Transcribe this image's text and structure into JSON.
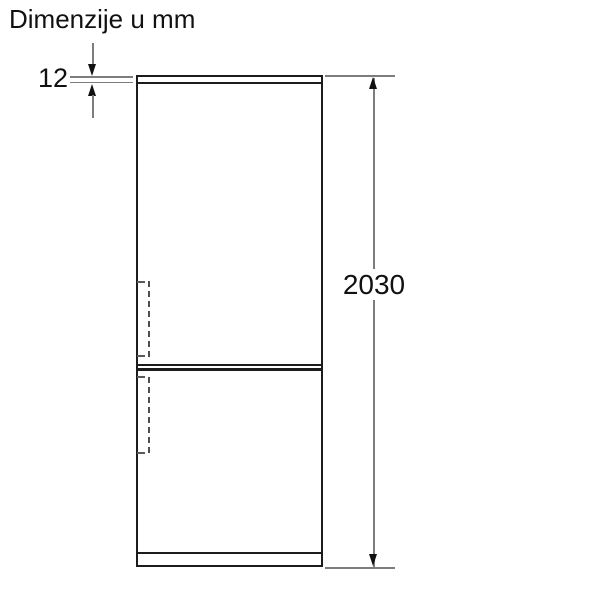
{
  "title": "Dimenzije u mm",
  "diagram": {
    "type": "appliance-dimension-drawing",
    "dimensions": {
      "top_thickness": {
        "value": "12",
        "unit": "mm"
      },
      "overall_height": {
        "value": "2030",
        "unit": "mm"
      }
    }
  },
  "colors": {
    "outline": "#1c1c1c",
    "dim-line": "#7d7d7d",
    "dash": "#4f4f4f",
    "text": "#111111",
    "background": "#ffffff"
  }
}
